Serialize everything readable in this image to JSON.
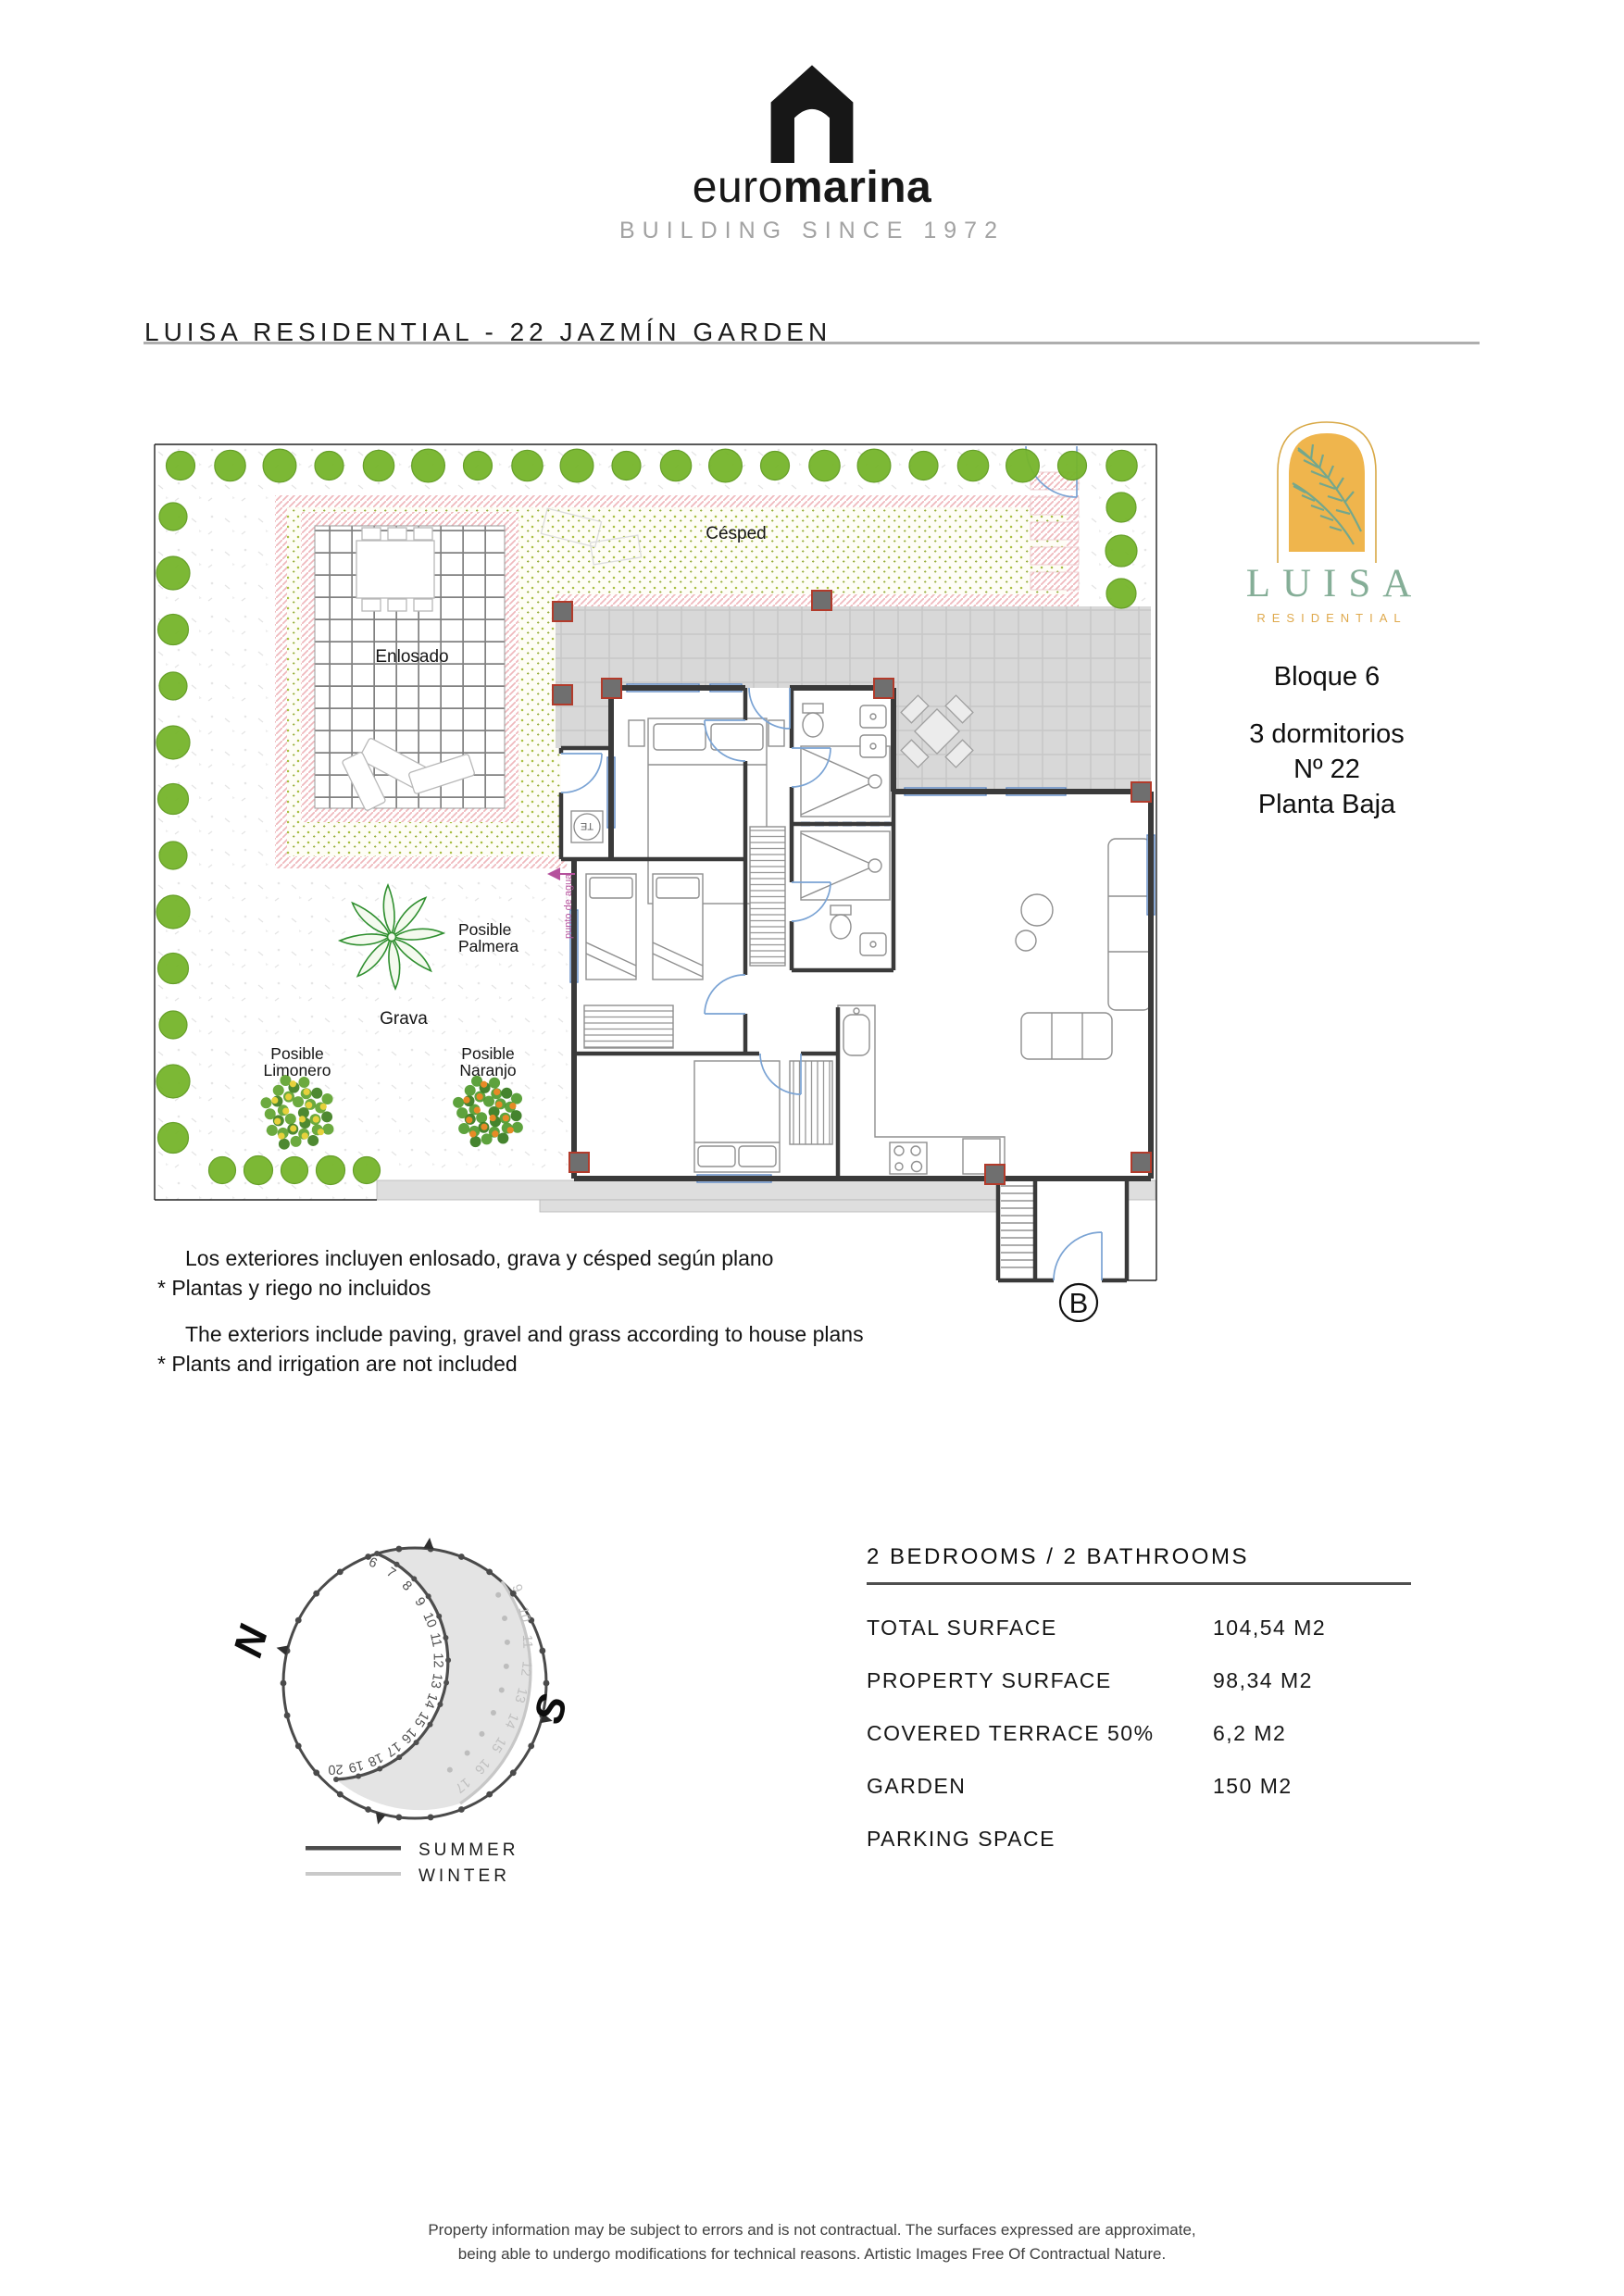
{
  "brand": {
    "logo_text_light": "euro",
    "logo_text_bold": "marina",
    "tagline": "BUILDING SINCE 1972"
  },
  "page_title": "LUISA RESIDENTIAL - 22 JAZMÍN GARDEN",
  "project": {
    "name": "LUISA",
    "subtitle": "RESIDENTIAL",
    "block": "Bloque 6",
    "bedrooms": "3 dormitorios",
    "unit_number": "Nº 22",
    "floor": "Planta Baja"
  },
  "plan_labels": {
    "cesped": "Césped",
    "enlosado": "Enlosado",
    "grava": "Grava",
    "palmera": [
      "Posible",
      "Palmera"
    ],
    "limonero": [
      "Posible",
      "Limonero"
    ],
    "naranjo": [
      "Posible",
      "Naranjo"
    ],
    "punto_de_agua": "punto de agua",
    "water_heater": "TE",
    "entrance_label": "B"
  },
  "notes": {
    "es_line1": "Los exteriores incluyen enlosado, grava y césped según plano",
    "es_line2": "* Plantas y riego no incluidos",
    "en_line1": "The exteriors include paving, gravel and grass according to house plans",
    "en_line2": "* Plants and irrigation are not included"
  },
  "sun_diagram": {
    "north_label": "N",
    "south_label": "S",
    "summer_label": "SUMMER",
    "winter_label": "WINTER",
    "summer_hours": [
      "6",
      "7",
      "8",
      "9",
      "10",
      "11",
      "12",
      "13",
      "14",
      "15",
      "16",
      "17",
      "18",
      "19",
      "20"
    ],
    "winter_hours": [
      "9",
      "10",
      "11",
      "12",
      "13",
      "14",
      "15",
      "16",
      "17"
    ]
  },
  "details": {
    "header": "2 BEDROOMS / 2 BATHROOMS",
    "rows": [
      {
        "label": "TOTAL SURFACE",
        "value": "104,54 M2"
      },
      {
        "label": "PROPERTY SURFACE",
        "value": "98,34 M2"
      },
      {
        "label": "COVERED TERRACE 50%",
        "value": "6,2 M2"
      },
      {
        "label": "GARDEN",
        "value": "150 M2"
      },
      {
        "label": "PARKING SPACE",
        "value": ""
      }
    ]
  },
  "footer": {
    "line1": "Property information may be subject to errors and is not contractual. The surfaces expressed are approximate,",
    "line2": "being able to undergo modifications for technical reasons. Artistic Images Free Of Contractual Nature."
  },
  "colors": {
    "tree_green": "#76b52b",
    "tree_edge": "#5e9a1e",
    "grass_dot": "#a9bf42",
    "pink_hatch": "#efb9bd",
    "terrace_gray": "#d8d8d8",
    "plan_blue": "#6f9ac9",
    "accent_red": "#b23b2b",
    "magenta": "#b5519c",
    "luisa_green": "#85ae97",
    "luisa_gold": "#e2a94d",
    "lemon_yellow": "#e6d13c",
    "orange_fruit": "#e78a26"
  }
}
